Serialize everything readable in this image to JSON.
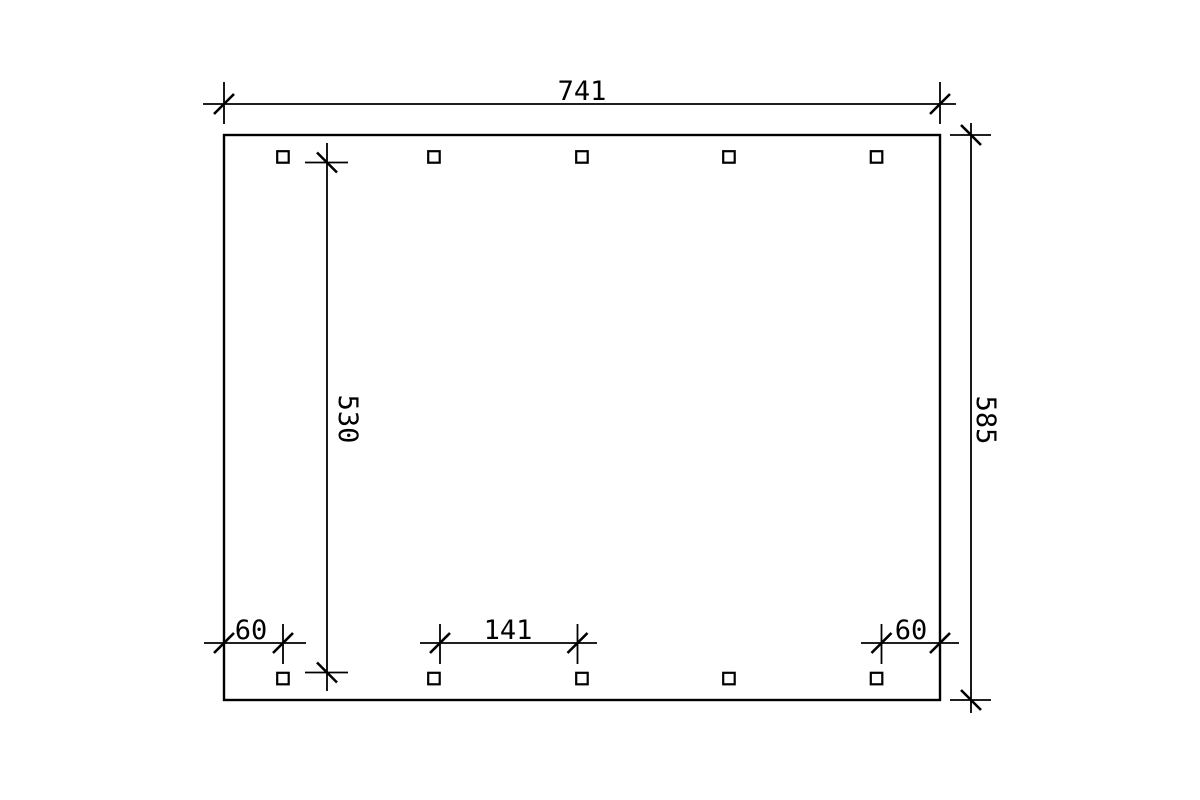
{
  "drawing": {
    "type": "carport-ground-plan",
    "colors": {
      "line": "#000000",
      "background": "#ffffff"
    },
    "labels": {
      "overall_width": "741",
      "overall_depth": "585",
      "inner_post_depth": "530",
      "post_offset_left": "60",
      "post_clear_spacing": "141",
      "post_offset_right": "60"
    }
  }
}
